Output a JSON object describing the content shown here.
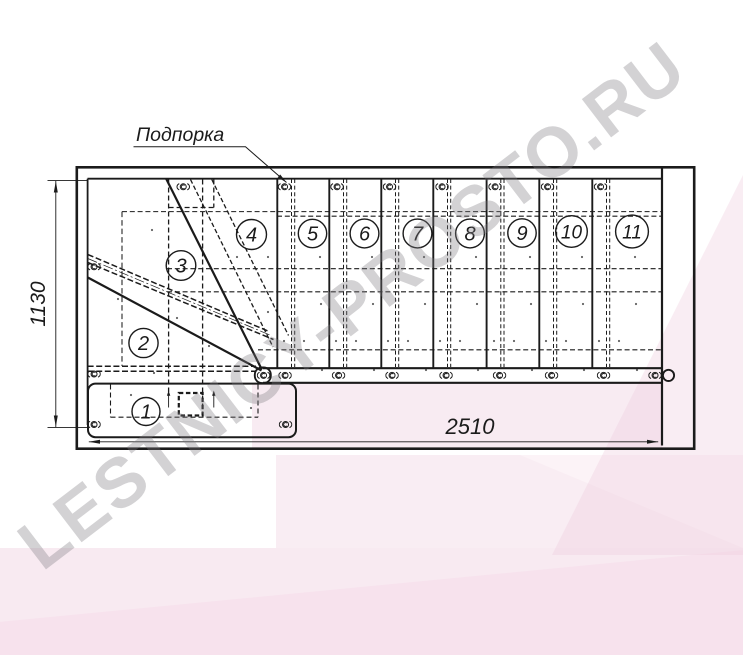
{
  "drawing": {
    "callout": {
      "label": "Подпорка"
    },
    "dimensions": {
      "height_mm": "1130",
      "width_mm": "2510"
    },
    "steps": [
      {
        "label": "1"
      },
      {
        "label": "2"
      },
      {
        "label": "3"
      },
      {
        "label": "4"
      },
      {
        "label": "5"
      },
      {
        "label": "6"
      },
      {
        "label": "7"
      },
      {
        "label": "8"
      },
      {
        "label": "9"
      },
      {
        "label": "10"
      },
      {
        "label": "11"
      }
    ]
  },
  "watermark": {
    "text": "LESTNICY-PROSTO.RU"
  },
  "colors": {
    "line": "#1b1b1b",
    "pink_band": "#f8eaf1",
    "pink_band_light": "#f9edf3",
    "watermark_gray": "#c9c7ca"
  }
}
